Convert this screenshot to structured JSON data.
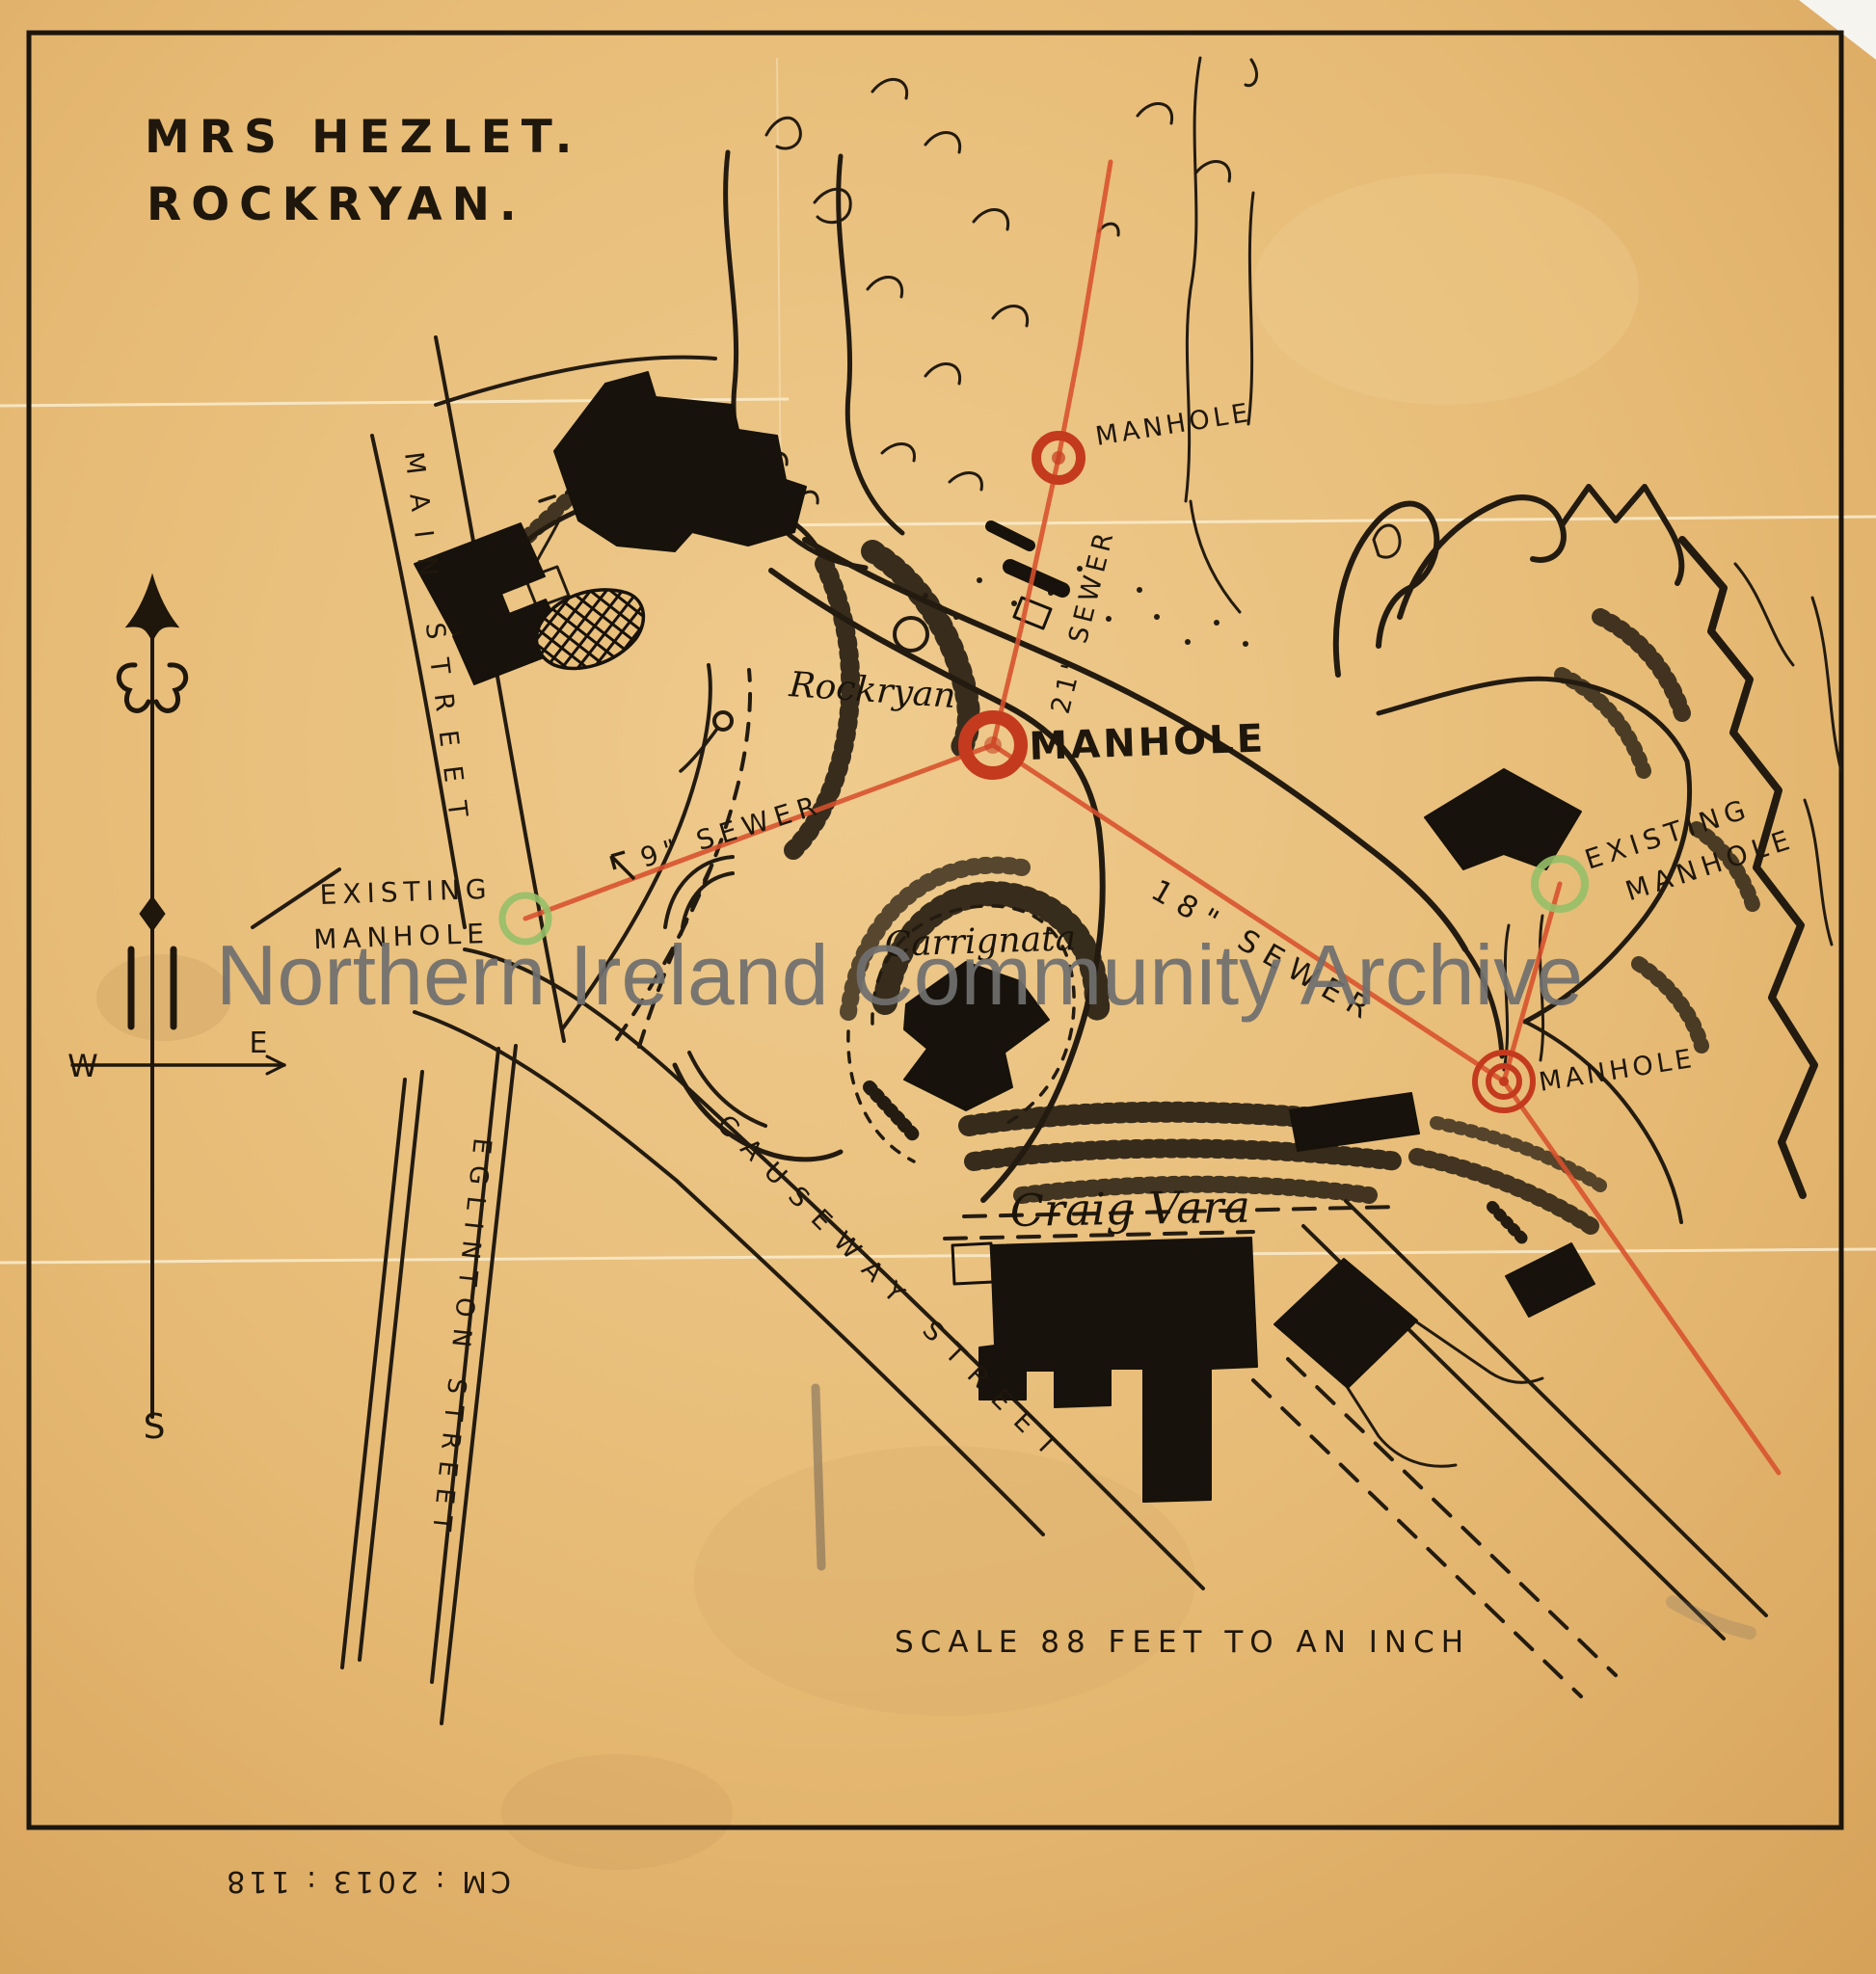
{
  "document": {
    "title_line1": "MRS HEZLET.",
    "title_line2": "ROCKRYAN.",
    "scale_note": "SCALE 88 FEET TO AN INCH",
    "accession_note": "CM : 2013 : 118"
  },
  "watermark": {
    "text": "Northern Ireland Community Archive",
    "color": "#6f6f6f"
  },
  "compass": {
    "west": "W",
    "east": "E",
    "south": "S"
  },
  "streets": [
    {
      "id": "main-street",
      "label": "MAIN STREET"
    },
    {
      "id": "eglinton-street",
      "label": "EGLINTON STREET"
    },
    {
      "id": "causeway-street",
      "label": "CAUSEWAY STREET"
    }
  ],
  "places": [
    {
      "id": "rockryan",
      "label": "Rockryan"
    },
    {
      "id": "carrignata",
      "label": "Carrignata"
    },
    {
      "id": "craig-vara",
      "label": "Craig Vara"
    }
  ],
  "sewers": [
    {
      "id": "sewer-21",
      "label": "21\" SEWER"
    },
    {
      "id": "sewer-9",
      "label": "9\" SEWER"
    },
    {
      "id": "sewer-18",
      "label": "18\" SEWER"
    }
  ],
  "manholes": [
    {
      "id": "manhole-top",
      "label": "MANHOLE",
      "type": "proposed"
    },
    {
      "id": "manhole-central",
      "label": "MANHOLE",
      "type": "proposed"
    },
    {
      "id": "manhole-east",
      "label": "MANHOLE",
      "type": "proposed"
    },
    {
      "id": "existing-manhole-west",
      "line1": "EXISTING",
      "line2": "MANHOLE",
      "type": "existing"
    },
    {
      "id": "existing-manhole-east",
      "line1": "EXISTING",
      "line2": "MANHOLE",
      "type": "existing"
    }
  ],
  "colors": {
    "paper": "#e9c07c",
    "ink": "#1f170c",
    "sewer_red": "#d7502c",
    "manhole_red": "#c43a1e",
    "existing_manhole_green": "#96bf68",
    "watermark_gray": "#6f6f6f"
  }
}
